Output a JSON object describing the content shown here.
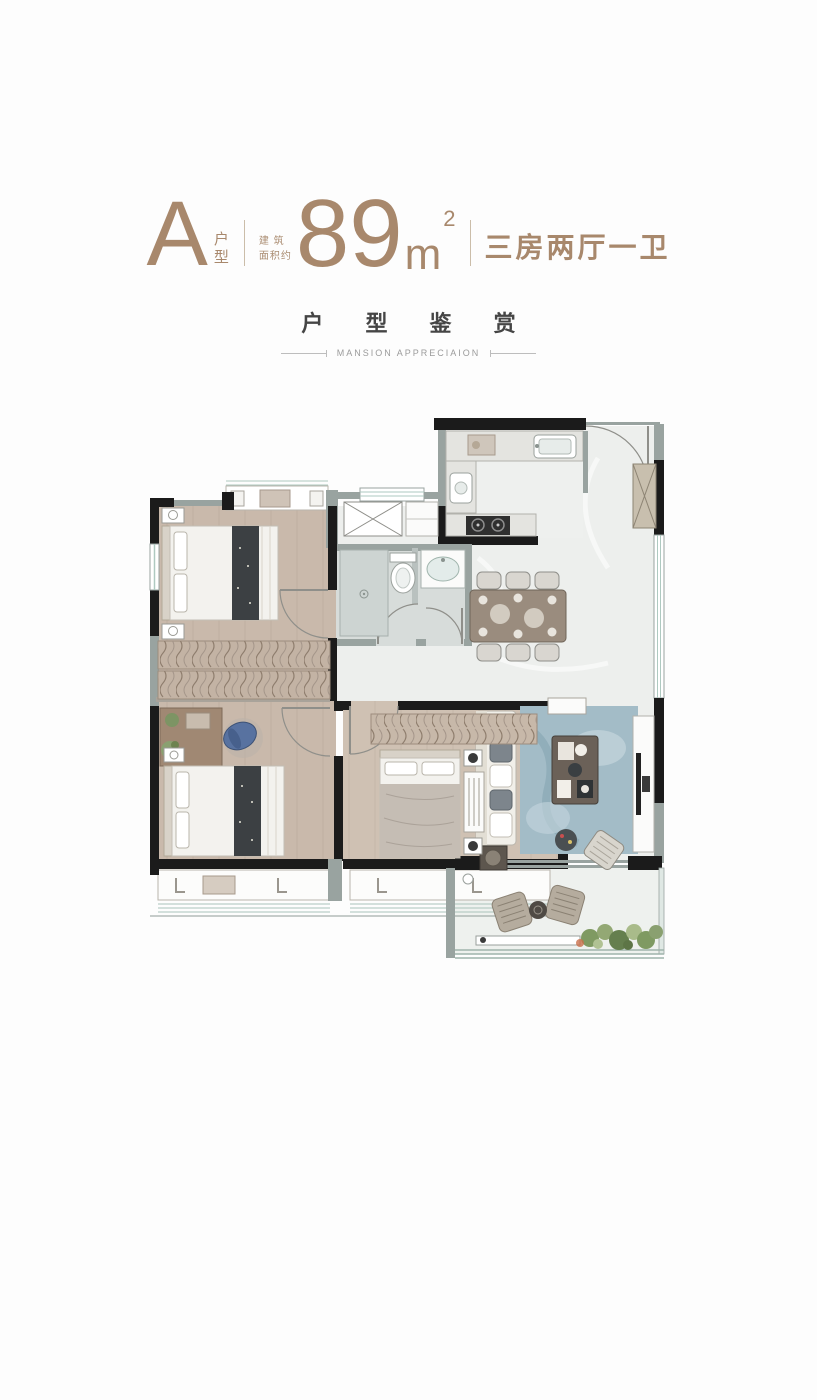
{
  "header": {
    "unit_letter": "A",
    "unit_label_top": "户",
    "unit_label_bottom": "型",
    "area_prefix_line1": "建 筑",
    "area_prefix_line2": "面积约",
    "area_value": "89",
    "area_unit": "m",
    "area_exponent": "2",
    "layout_text": "三房两厅一卫",
    "accent_color": "#a8886c"
  },
  "section": {
    "title": "户 型 鉴 赏",
    "subtitle": "MANSION APPRECIAION",
    "title_color": "#454545",
    "subtitle_color": "#9b9b9b"
  },
  "floorplan": {
    "wall_color": "#1b1b1b",
    "secondary_wall_color": "#99a3a0",
    "wood_floor_color": "#c9b9ab",
    "wood_floor_light_color": "#cfc1b3",
    "marble_floor_color": "#edefed",
    "tile_floor_color": "#d7dcda",
    "rug_color": "#a3bcc7",
    "sofa_color": "#f1efe9",
    "table_wood_color": "#9a8c7e",
    "bed_runner_color": "#3c4043",
    "plant_color": "#7f9a62",
    "glass_color": "#aec9c0",
    "room_names": [
      "kitchen",
      "entry",
      "dining-area",
      "living-room",
      "bathroom",
      "bedroom-1",
      "bedroom-2",
      "bedroom-3",
      "balcony",
      "bay-window"
    ]
  }
}
